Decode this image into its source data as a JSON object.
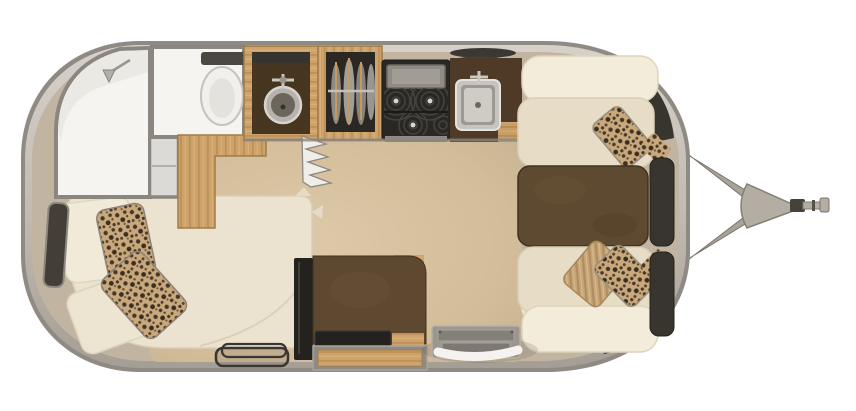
{
  "scene": {
    "title": "travel-trailer-floorplan-top-view",
    "canvas_width": 856,
    "canvas_height": 411,
    "background": "#ffffff",
    "view": "overhead interior rendering, hitch pointing right"
  },
  "palette": {
    "shell_rim": "#8f8a83",
    "shell_band_light": "#d6d1c9",
    "shell_band_dark": "#a49e95",
    "interior": "#c1b5a2",
    "floor_light": "#ddc9a8",
    "floor_dark": "#c9b493",
    "wall": "#8b867f",
    "room_white": "#f5f4f1",
    "wood": "#cda26b",
    "wood_dark": "#b98f55",
    "counter": "#4e3a27",
    "table": "#5e4a31",
    "stove": "#2a2825",
    "metal": "#b6b1a9",
    "metal_dark": "#8a857c",
    "trim": "#38342e",
    "cushion": "#efe7d5",
    "cushion_dark": "#e7ddc6",
    "pillow": "#f3ecdb",
    "leopard_base": "#c9a97c",
    "leopard_spot": "#45372a",
    "tan_pillow": "#c6a477",
    "tv": "#23221f",
    "handle": "#f5f3ef"
  },
  "furniture": {
    "shell": {
      "label": "Rounded aluminum trailer shell"
    },
    "hitch": {
      "label": "A-frame tongue with coupler and jack"
    },
    "shower": {
      "label": "Corner shower with shower head"
    },
    "toilet_room": {
      "label": "Enclosed toilet room"
    },
    "toilet": {
      "label": "Toilet"
    },
    "bath_cabinet": {
      "label": "Bathroom cabinet"
    },
    "wood_partition": {
      "label": "Wood partition cabinet"
    },
    "vanity": {
      "label": "Vanity with round vessel sink"
    },
    "accordion_door": {
      "label": "Accordion privacy door"
    },
    "wardrobe": {
      "label": "Hanging wardrobe closet"
    },
    "cooktop": {
      "label": "Gas cooktop with grate and knobs"
    },
    "speaker_grilles": {
      "label": "Speaker grilles"
    },
    "kitchen_sink": {
      "label": "Square stainless kitchen sink"
    },
    "galley_counter": {
      "label": "Galley countertop"
    },
    "dinette_bench_top": {
      "label": "Dinette bench seat (upper)"
    },
    "dinette_bench_bottom": {
      "label": "Dinette bench seat (lower)"
    },
    "dinette_table": {
      "label": "Dinette table"
    },
    "headrest_panels": {
      "label": "Dinette headrest panels"
    },
    "bed": {
      "label": "Bed with pillows"
    },
    "bed_window": {
      "label": "Bedroom window"
    },
    "bedside_mat": {
      "label": "Fold-away step mat"
    },
    "media_cabinet": {
      "label": "Media cabinet"
    },
    "tv": {
      "label": "Flat-screen TV"
    },
    "storage_drawer": {
      "label": "Storage drawer"
    },
    "entry_step": {
      "label": "Entry step well"
    },
    "grab_handle": {
      "label": "Entry grab handle"
    }
  }
}
